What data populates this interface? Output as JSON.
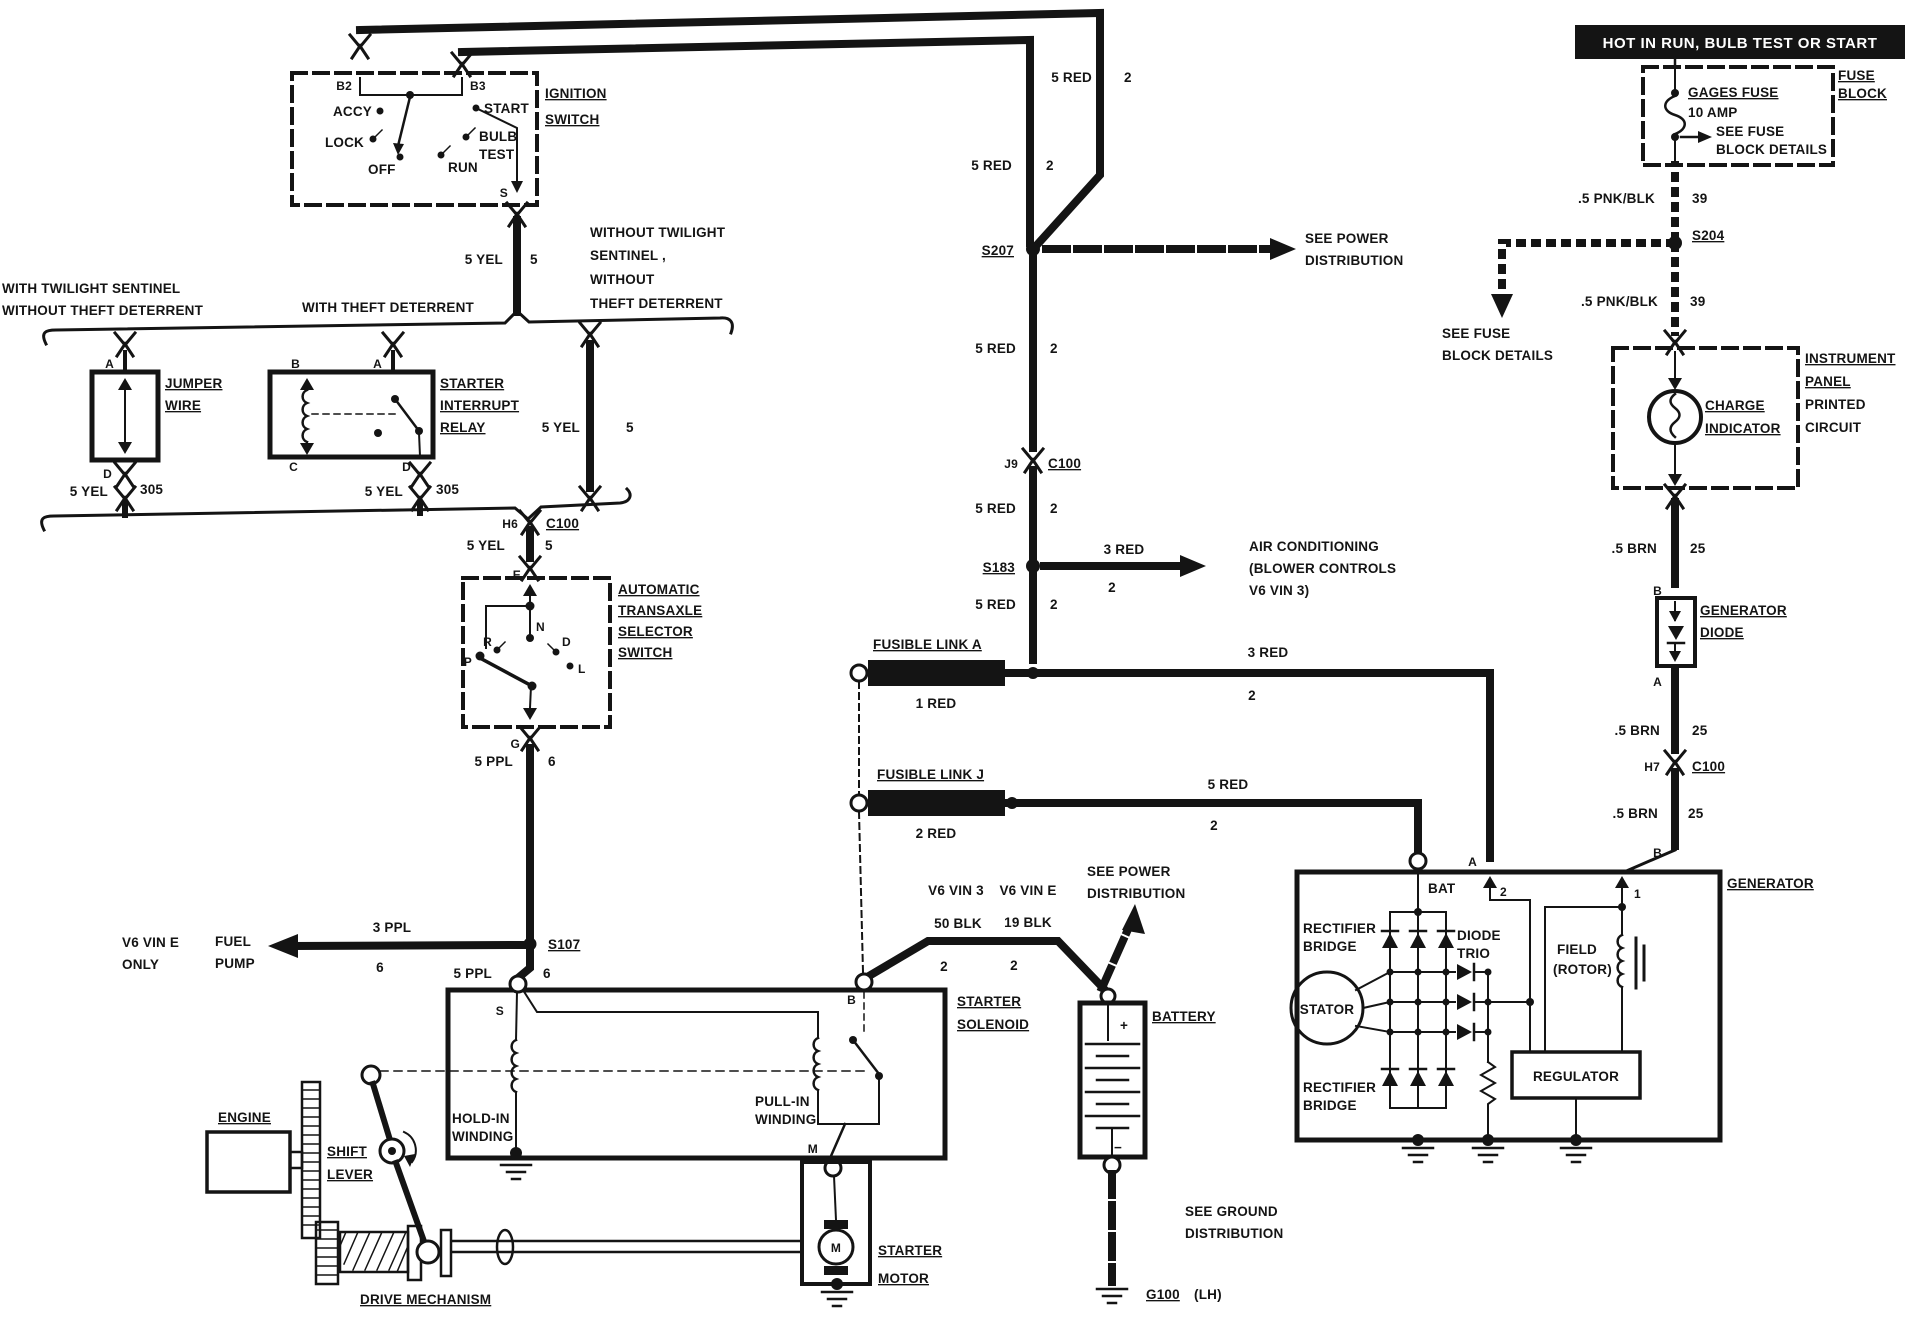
{
  "colors": {
    "ink": "#141414",
    "paper": "#ffffff",
    "banner_bg": "#000000",
    "banner_fg": "#ffffff"
  },
  "labels": {
    "banner": "HOT IN RUN, BULB TEST OR START",
    "ign": {
      "t1": "IGNITION",
      "t2": "SWITCH",
      "b2": "B2",
      "b3": "B3",
      "accy": "ACCY",
      "lock": "LOCK",
      "off": "OFF",
      "run": "RUN",
      "bulb": "BULB",
      "test": "TEST",
      "start": "START",
      "s": "S",
      "wire": "5 YEL",
      "ckt": "5"
    },
    "rails": {
      "red1": "5 RED",
      "c1": "2",
      "red2": "5 RED",
      "c2": "2"
    },
    "opts": {
      "tw1": "WITH TWILIGHT SENTINEL",
      "tw2": "WITHOUT THEFT DETERRENT",
      "theft": "WITH THEFT DETERRENT",
      "wo1": "WITHOUT TWILIGHT",
      "wo2": "SENTINEL ,",
      "wo3": "WITHOUT",
      "wo4": "THEFT DETERRENT"
    },
    "jumper": {
      "t1": "JUMPER",
      "t2": "WIRE",
      "a": "A",
      "d": "D",
      "wire": "5 YEL",
      "ckt": "305"
    },
    "relay": {
      "t1": "STARTER",
      "t2": "INTERRUPT",
      "t3": "RELAY",
      "a": "A",
      "b": "B",
      "c": "C",
      "d": "D",
      "wire": "5 YEL",
      "ckt": "305"
    },
    "branch": {
      "wire": "5 YEL",
      "ckt": "5"
    },
    "c100a": {
      "pin": "H6",
      "name": "C100",
      "wire": "5 YEL",
      "ckt": "5",
      "e": "E"
    },
    "trans": {
      "t1": "AUTOMATIC",
      "t2": "TRANSAXLE",
      "t3": "SELECTOR",
      "t4": "SWITCH",
      "g": "G",
      "p": "P",
      "r": "R",
      "n": "N",
      "d": "D",
      "l": "L",
      "wire": "5 PPL",
      "ckt": "6"
    },
    "fuel": {
      "splice": "S107",
      "wire": "3 PPL",
      "ckt": "6",
      "t1": "FUEL",
      "t2": "PUMP",
      "v1": "V6 VIN E",
      "v2": "ONLY",
      "wire2": "5 PPL",
      "ckt2": "6"
    },
    "trunk": {
      "s207": "S207",
      "pd1": "SEE POWER",
      "pd2": "DISTRIBUTION",
      "red1": "5 RED",
      "c1": "2",
      "j9": "J9",
      "c100": "C100",
      "red2": "5 RED",
      "c2": "2",
      "s183": "S183",
      "acw": "3 RED",
      "acc": "2",
      "ac1": "AIR CONDITIONING",
      "ac2": "(BLOWER CONTROLS",
      "ac3": "V6 VIN 3)",
      "red3": "5 RED",
      "c3": "2"
    },
    "linka": {
      "t": "FUSIBLE LINK A",
      "id": "1 RED",
      "wire": "3 RED",
      "ckt": "2"
    },
    "linkj": {
      "t": "FUSIBLE LINK J",
      "id": "2 RED",
      "wire": "5 RED",
      "ckt": "2"
    },
    "sol": {
      "v3": "V6 VIN 3",
      "ve": "V6 VIN E",
      "w3": "50 BLK",
      "c3": "2",
      "we": "19 BLK",
      "ce": "2",
      "pd1": "SEE POWER",
      "pd2": "DISTRIBUTION",
      "t1": "STARTER",
      "t2": "SOLENOID",
      "b": "B",
      "s": "S",
      "m": "M",
      "h1": "HOLD-IN",
      "h2": "WINDING",
      "p1": "PULL-IN",
      "p2": "WINDING"
    },
    "batt": {
      "t": "BATTERY",
      "plus": "+",
      "minus": "−",
      "gnd1": "SEE GROUND",
      "gnd2": "DISTRIBUTION",
      "g100": "G100",
      "lh": "(LH)"
    },
    "motor": {
      "t1": "STARTER",
      "t2": "MOTOR",
      "m": "M"
    },
    "mech": {
      "engine": "ENGINE",
      "s1": "SHIFT",
      "s2": "LEVER",
      "d": "DRIVE MECHANISM"
    },
    "fuse": {
      "gages": "GAGES FUSE",
      "amp": "10 AMP",
      "see1": "SEE FUSE",
      "see2": "BLOCK DETAILS",
      "f": "FUSE",
      "b": "BLOCK"
    },
    "pnk": {
      "w1": ".5 PNK/BLK",
      "c1": "39",
      "s204": "S204",
      "w2": ".5 PNK/BLK",
      "c2": "39",
      "see1": "SEE FUSE",
      "see2": "BLOCK DETAILS"
    },
    "ip": {
      "t1": "INSTRUMENT",
      "t2": "PANEL",
      "t3": "PRINTED",
      "t4": "CIRCUIT",
      "c1": "CHARGE",
      "c2": "INDICATOR"
    },
    "gdio": {
      "w1": ".5 BRN",
      "c1": "25",
      "b": "B",
      "t1": "GENERATOR",
      "t2": "DIODE",
      "a": "A",
      "w2": ".5 BRN",
      "c2": "25",
      "pin": "H7",
      "conn": "C100",
      "w3": ".5 BRN",
      "c3": "25"
    },
    "gen": {
      "t": "GENERATOR",
      "b": "B",
      "n1": "1",
      "a": "A",
      "n2": "2",
      "bat": "BAT",
      "rb1": "RECTIFIER",
      "rb2": "BRIDGE",
      "rb3": "RECTIFIER",
      "rb4": "BRIDGE",
      "dt1": "DIODE",
      "dt2": "TRIO",
      "stator": "STATOR",
      "f1": "FIELD",
      "f2": "(ROTOR)",
      "reg": "REGULATOR"
    }
  }
}
